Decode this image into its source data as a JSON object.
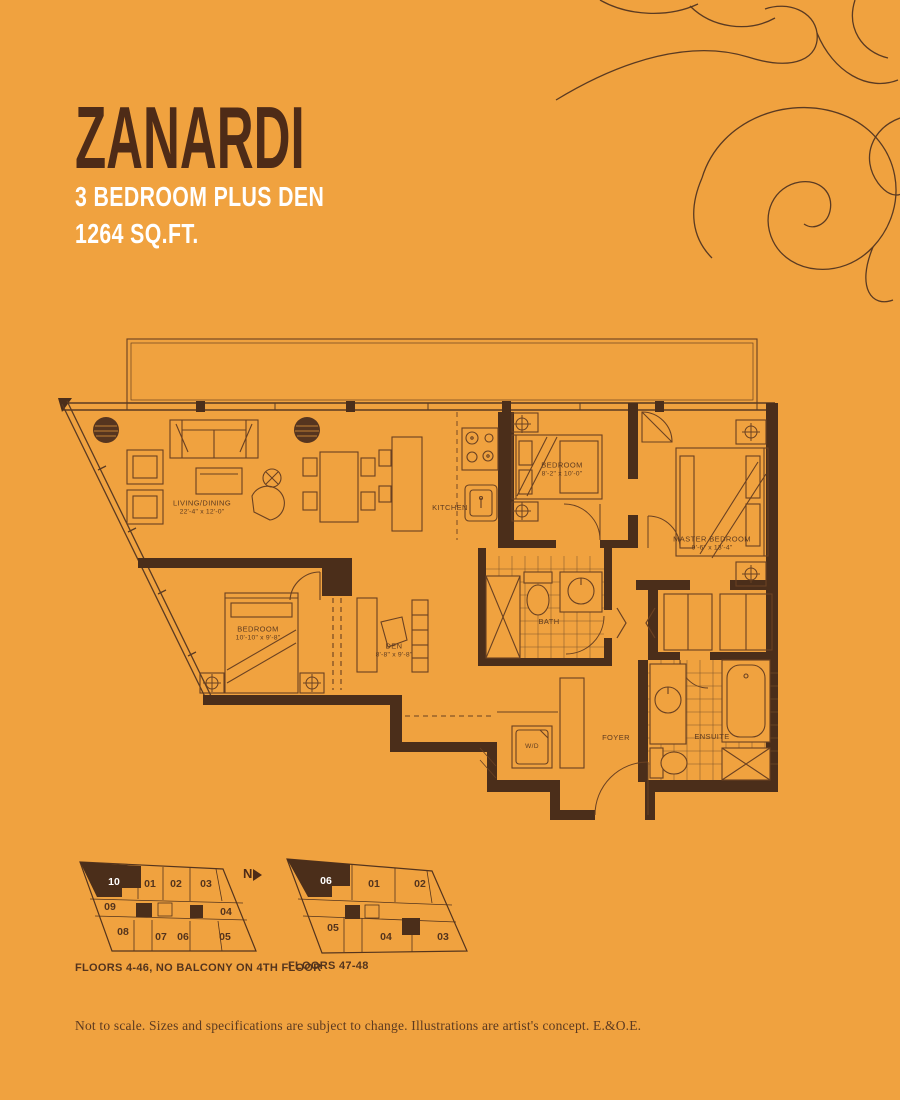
{
  "colors": {
    "background": "#F0A23F",
    "ink_dark": "#4E2B17",
    "line_brown": "#6A4122",
    "white": "#FFFFFF"
  },
  "header": {
    "title": "ZANARDI",
    "subtitle_line1": "3 BEDROOM PLUS DEN",
    "subtitle_line2": "1264 SQ.FT."
  },
  "floorplan": {
    "rooms": [
      {
        "name": "LIVING/DINING",
        "dims": "22'-4\" x 12'-0\""
      },
      {
        "name": "KITCHEN",
        "dims": ""
      },
      {
        "name": "BEDROOM",
        "dims": "8'-2\" x 10'-0\""
      },
      {
        "name": "MASTER BEDROOM",
        "dims": "9'-6\" x 13'-4\""
      },
      {
        "name": "BEDROOM",
        "dims": "10'-10\" x 9'-8\""
      },
      {
        "name": "DEN",
        "dims": "8'-8\" x 9'-8\""
      },
      {
        "name": "BATH",
        "dims": ""
      },
      {
        "name": "ENSUITE",
        "dims": ""
      },
      {
        "name": "FOYER",
        "dims": ""
      },
      {
        "name": "W/D",
        "dims": ""
      }
    ]
  },
  "north_indicator": "N",
  "keyplans": [
    {
      "caption": "FLOORS 4-46, NO BALCONY ON 4TH FLOOR",
      "highlight": "10",
      "units": [
        "01",
        "02",
        "03",
        "09",
        "04",
        "08",
        "07",
        "06",
        "05"
      ]
    },
    {
      "caption": "FLOORS 47-48",
      "highlight": "06",
      "units": [
        "01",
        "02",
        "05",
        "04",
        "03"
      ]
    }
  ],
  "footer": {
    "disclaimer": "Not to scale. Sizes and specifications are subject to change. Illustrations are artist's concept. E.&O.E."
  }
}
